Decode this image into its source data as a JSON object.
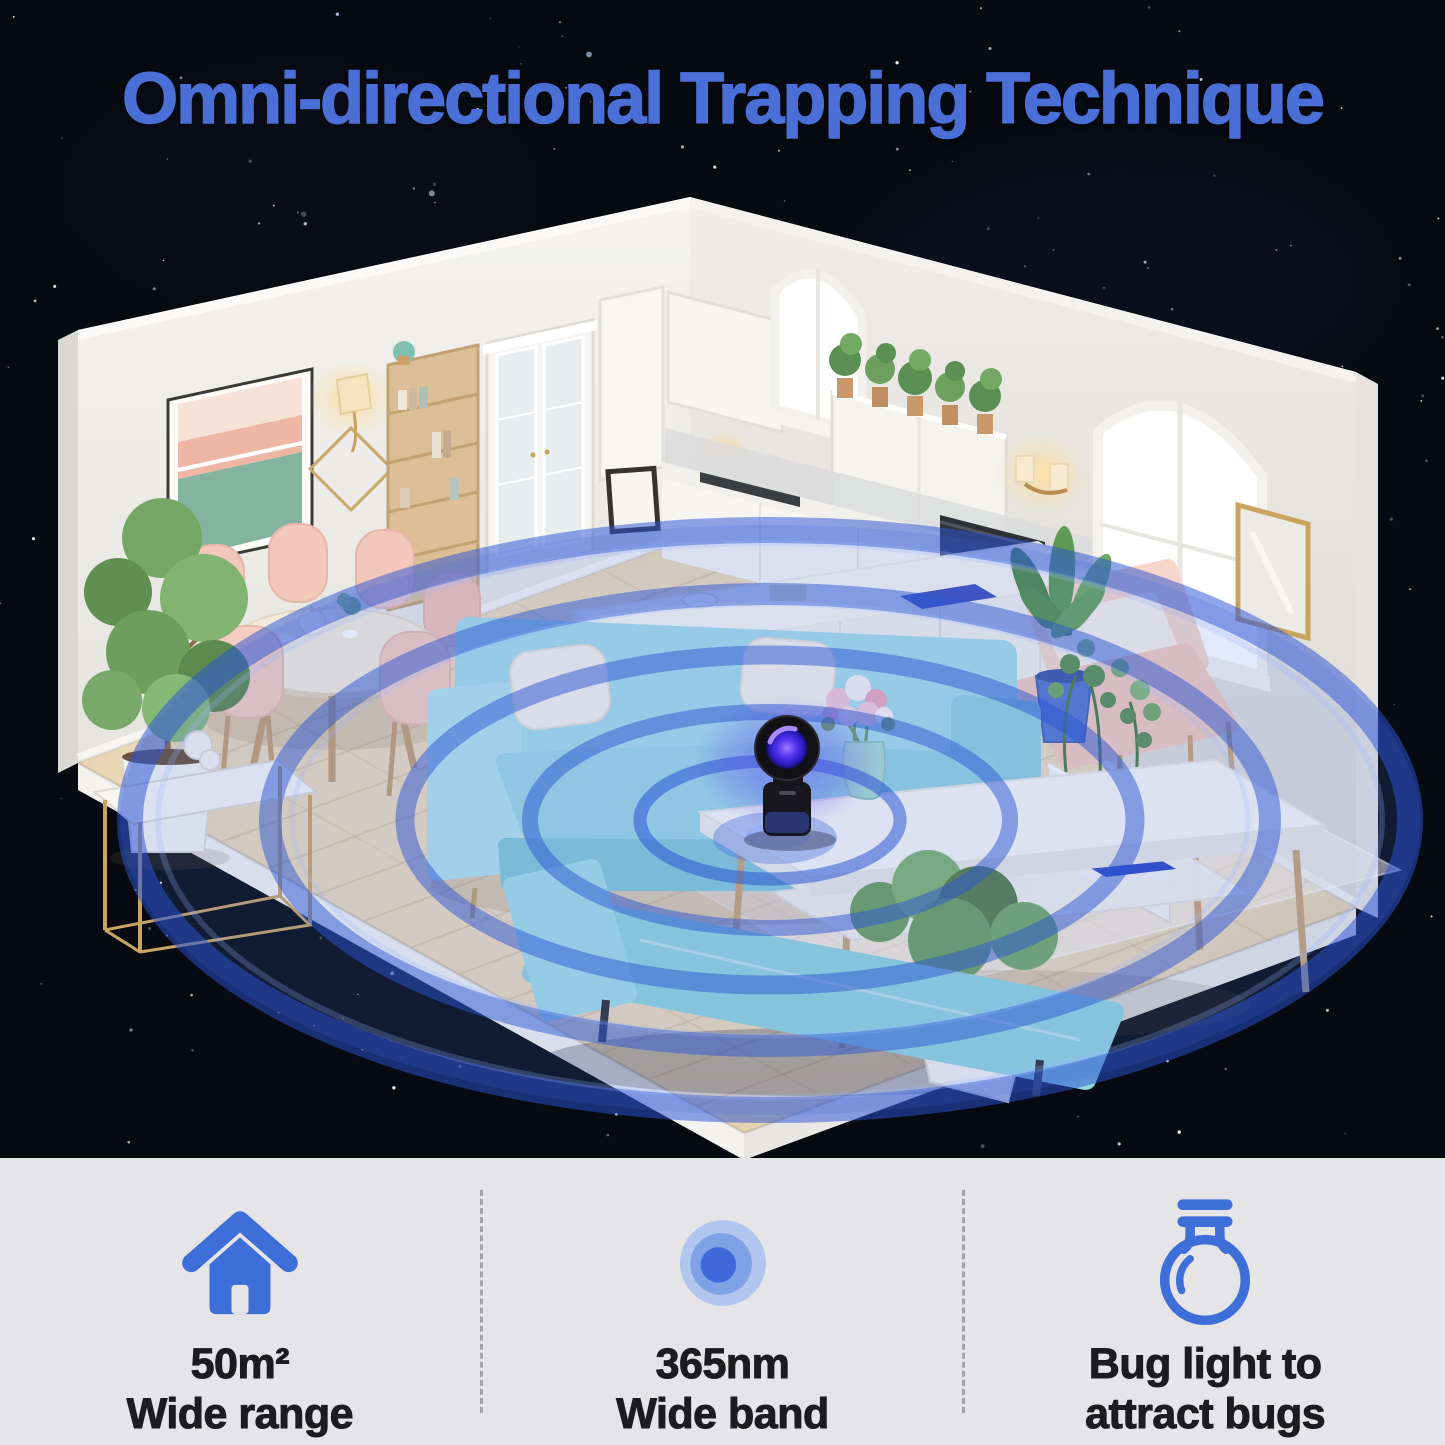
{
  "title": "Omni-directional Trapping Technique",
  "features": [
    {
      "icon": "house-icon",
      "line1": "50m²",
      "line2": "Wide range"
    },
    {
      "icon": "signal-dot-icon",
      "line1": "365nm",
      "line2": "Wide band"
    },
    {
      "icon": "bulb-icon",
      "line1": "Bug light to",
      "line2": "attract bugs"
    }
  ],
  "colors": {
    "headline": "#4a6fd6",
    "icon_blue": "#3e6fd8",
    "ring_blue": "#2c55d4",
    "panel_bg": "#e5e4e6",
    "text": "#1c1c1e",
    "sky": "#070a10"
  }
}
